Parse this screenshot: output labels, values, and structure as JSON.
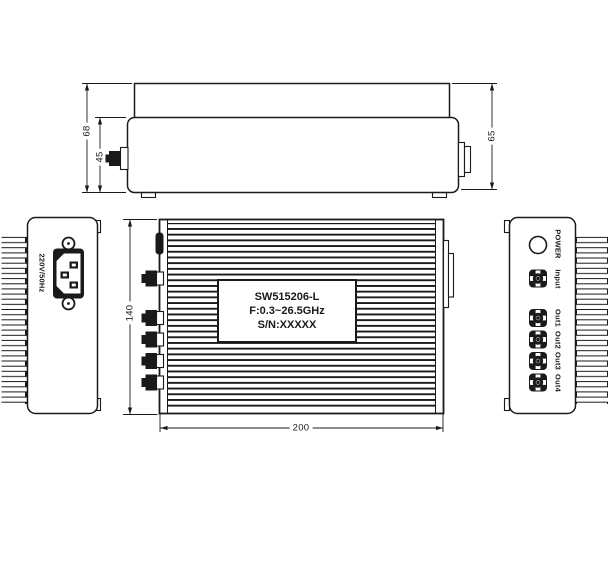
{
  "views": {
    "side": {
      "dims": {
        "total_height": "68",
        "body_height": "45",
        "right_height": "65"
      }
    },
    "front": {
      "dims": {
        "height": "140",
        "width": "200"
      },
      "nameplate": {
        "line1": "SW515206-L",
        "line2": "F:0.3~26.5GHz",
        "line3": "S/N:XXXXX"
      }
    },
    "power_panel": {
      "rating": "220V/50Hz"
    },
    "rf_panel": {
      "led_label": "POWER",
      "input_label": "Input",
      "output_labels": [
        "Out1",
        "Out2",
        "Out3",
        "Out4"
      ]
    }
  },
  "icons": {
    "power_inlet": "iec-c14-inlet-icon",
    "screw_hole": "screw-hole-icon",
    "rf_connector": "sma-connector-icon",
    "led": "power-led-icon",
    "heatsink": "heatsink-fins"
  },
  "colors": {
    "line": "#1a1a1a",
    "background": "#ffffff"
  }
}
